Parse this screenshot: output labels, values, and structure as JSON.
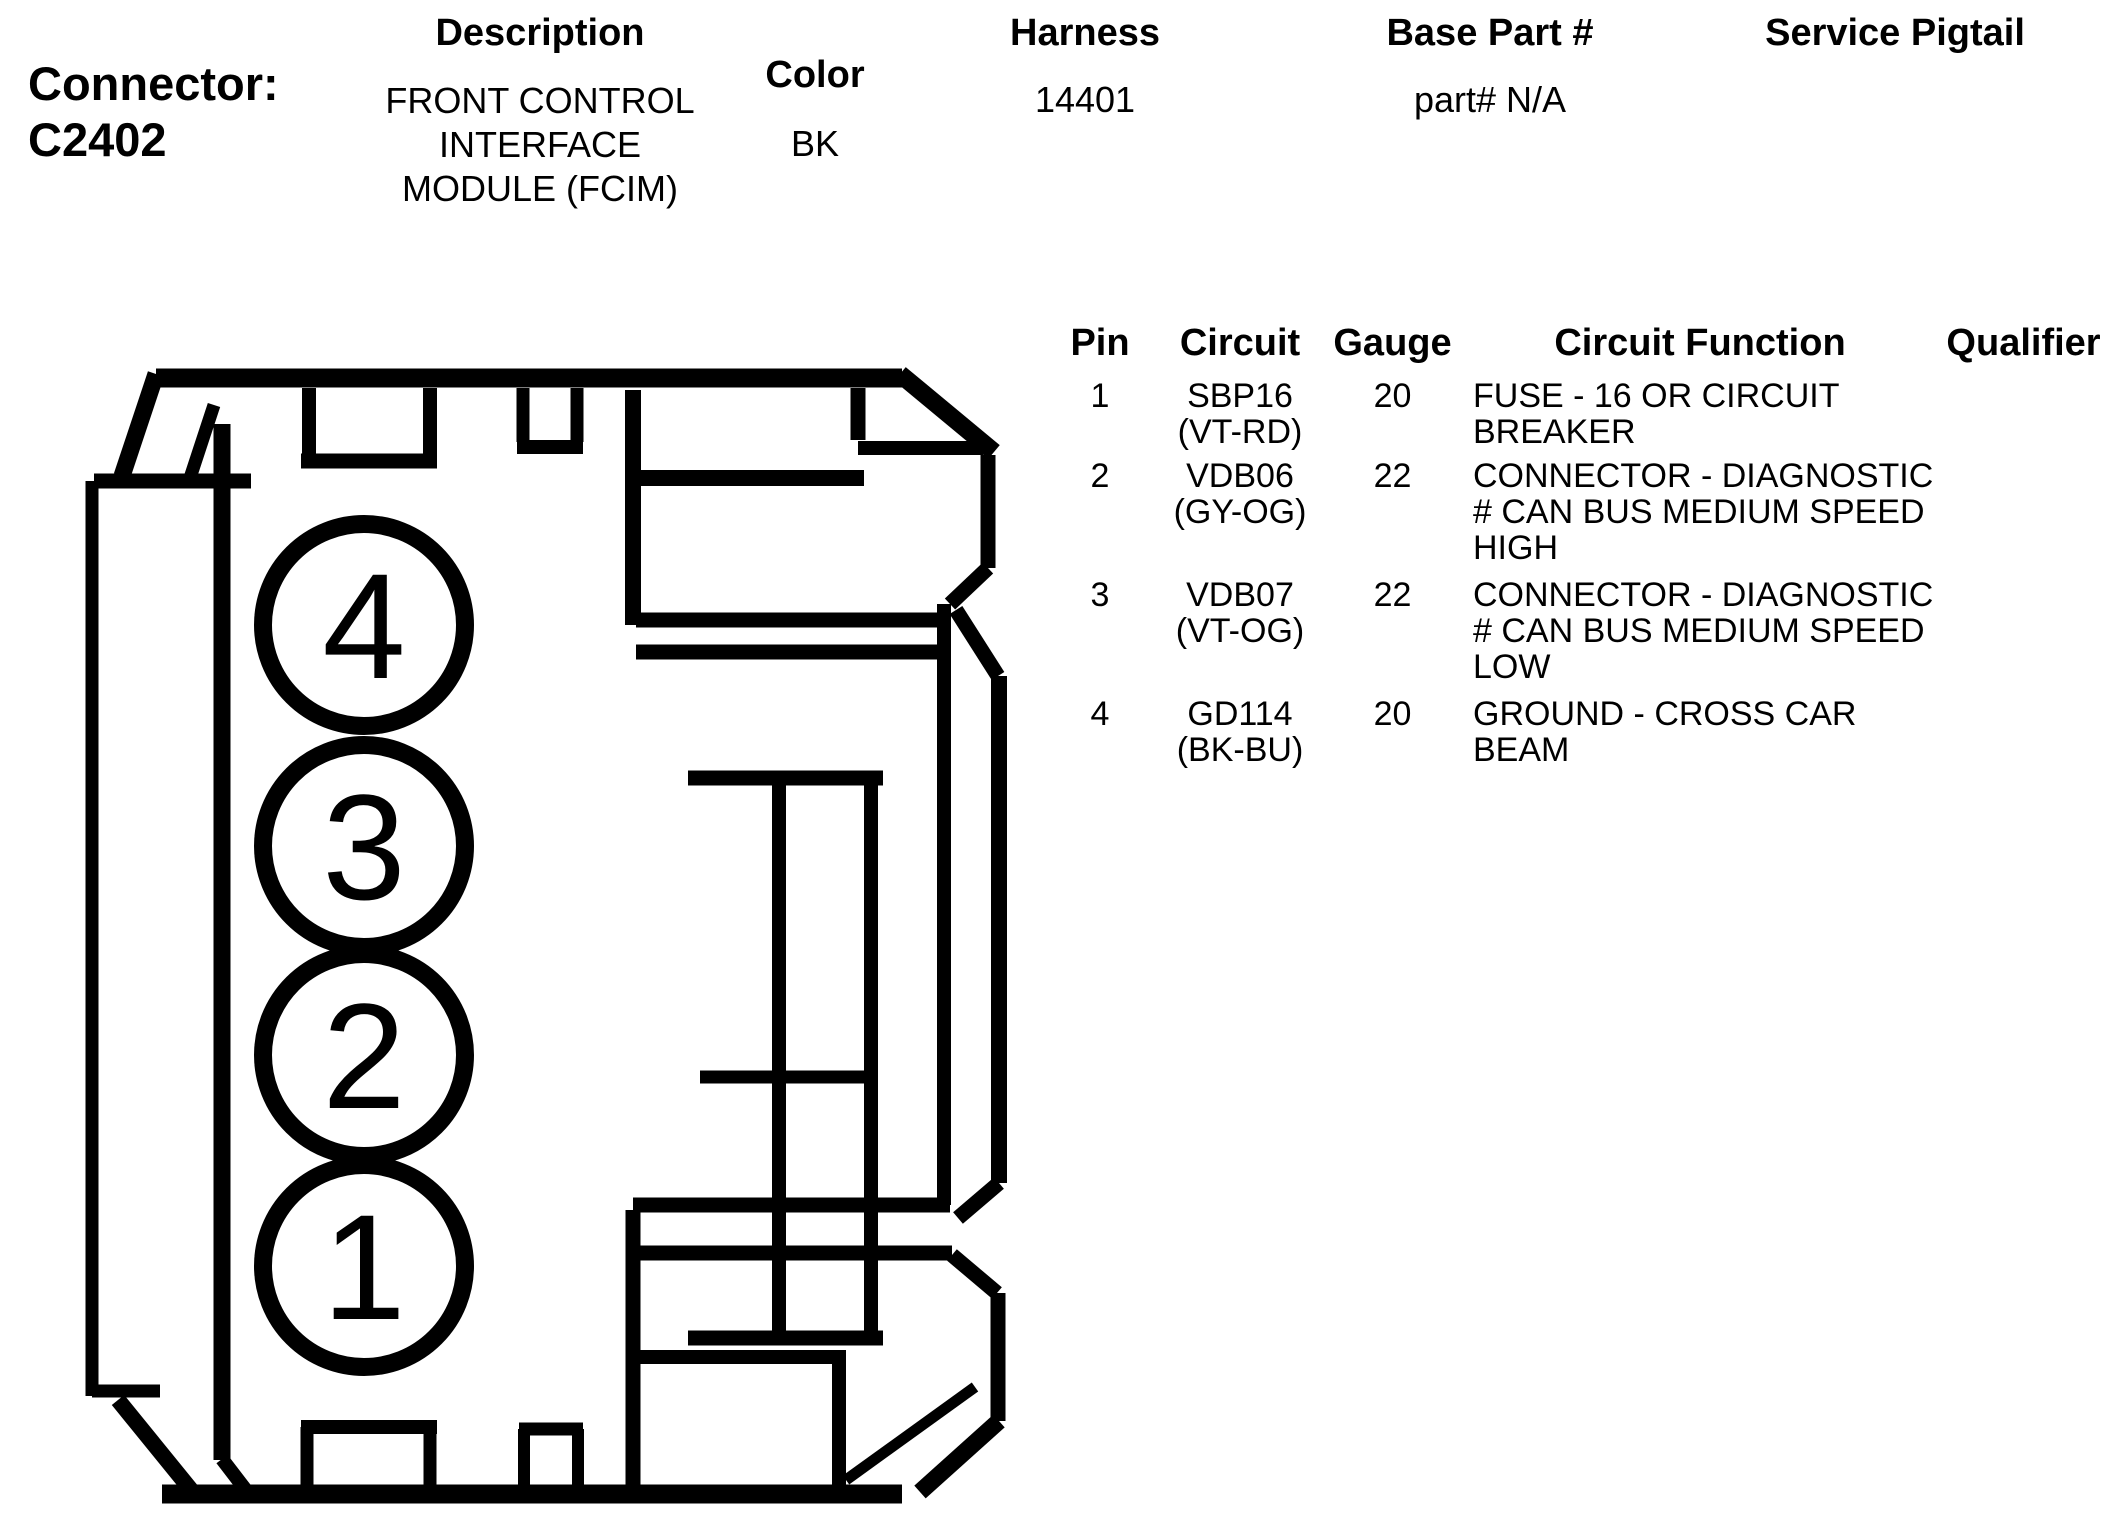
{
  "page": {
    "background": "#ffffff",
    "ink": "#000000"
  },
  "header": {
    "connector_label": "Connector:",
    "connector_id": "C2402",
    "description_label": "Description",
    "description_lines": [
      "FRONT CONTROL",
      "INTERFACE",
      "MODULE (FCIM)"
    ],
    "color_label": "Color",
    "color_value": "BK",
    "harness_label": "Harness",
    "harness_value": "14401",
    "base_part_label": "Base Part #",
    "base_part_value": "part# N/A",
    "service_pigtail_label": "Service Pigtail",
    "service_pigtail_value": ""
  },
  "pin_table": {
    "headers": {
      "pin": "Pin",
      "circuit": "Circuit",
      "gauge": "Gauge",
      "function": "Circuit Function",
      "qualifier": "Qualifier"
    },
    "rows": [
      {
        "pin": "1",
        "circuit": "SBP16",
        "circuit_color": "(VT-RD)",
        "gauge": "20",
        "function_lines": [
          "FUSE - 16 OR CIRCUIT",
          "BREAKER"
        ],
        "qualifier": ""
      },
      {
        "pin": "2",
        "circuit": "VDB06",
        "circuit_color": "(GY-OG)",
        "gauge": "22",
        "function_lines": [
          "CONNECTOR - DIAGNOSTIC",
          "# CAN BUS MEDIUM SPEED",
          "HIGH"
        ],
        "qualifier": ""
      },
      {
        "pin": "3",
        "circuit": "VDB07",
        "circuit_color": "(VT-OG)",
        "gauge": "22",
        "function_lines": [
          "CONNECTOR - DIAGNOSTIC",
          "# CAN BUS MEDIUM SPEED",
          "LOW"
        ],
        "qualifier": ""
      },
      {
        "pin": "4",
        "circuit": "GD114",
        "circuit_color": "(BK-BU)",
        "gauge": "20",
        "function_lines": [
          "GROUND - CROSS CAR",
          "BEAM"
        ],
        "qualifier": ""
      }
    ]
  },
  "connector_drawing": {
    "view": "rear view of 4-way connector housing",
    "pins": [
      {
        "number": "4"
      },
      {
        "number": "3"
      },
      {
        "number": "2"
      },
      {
        "number": "1"
      }
    ]
  }
}
